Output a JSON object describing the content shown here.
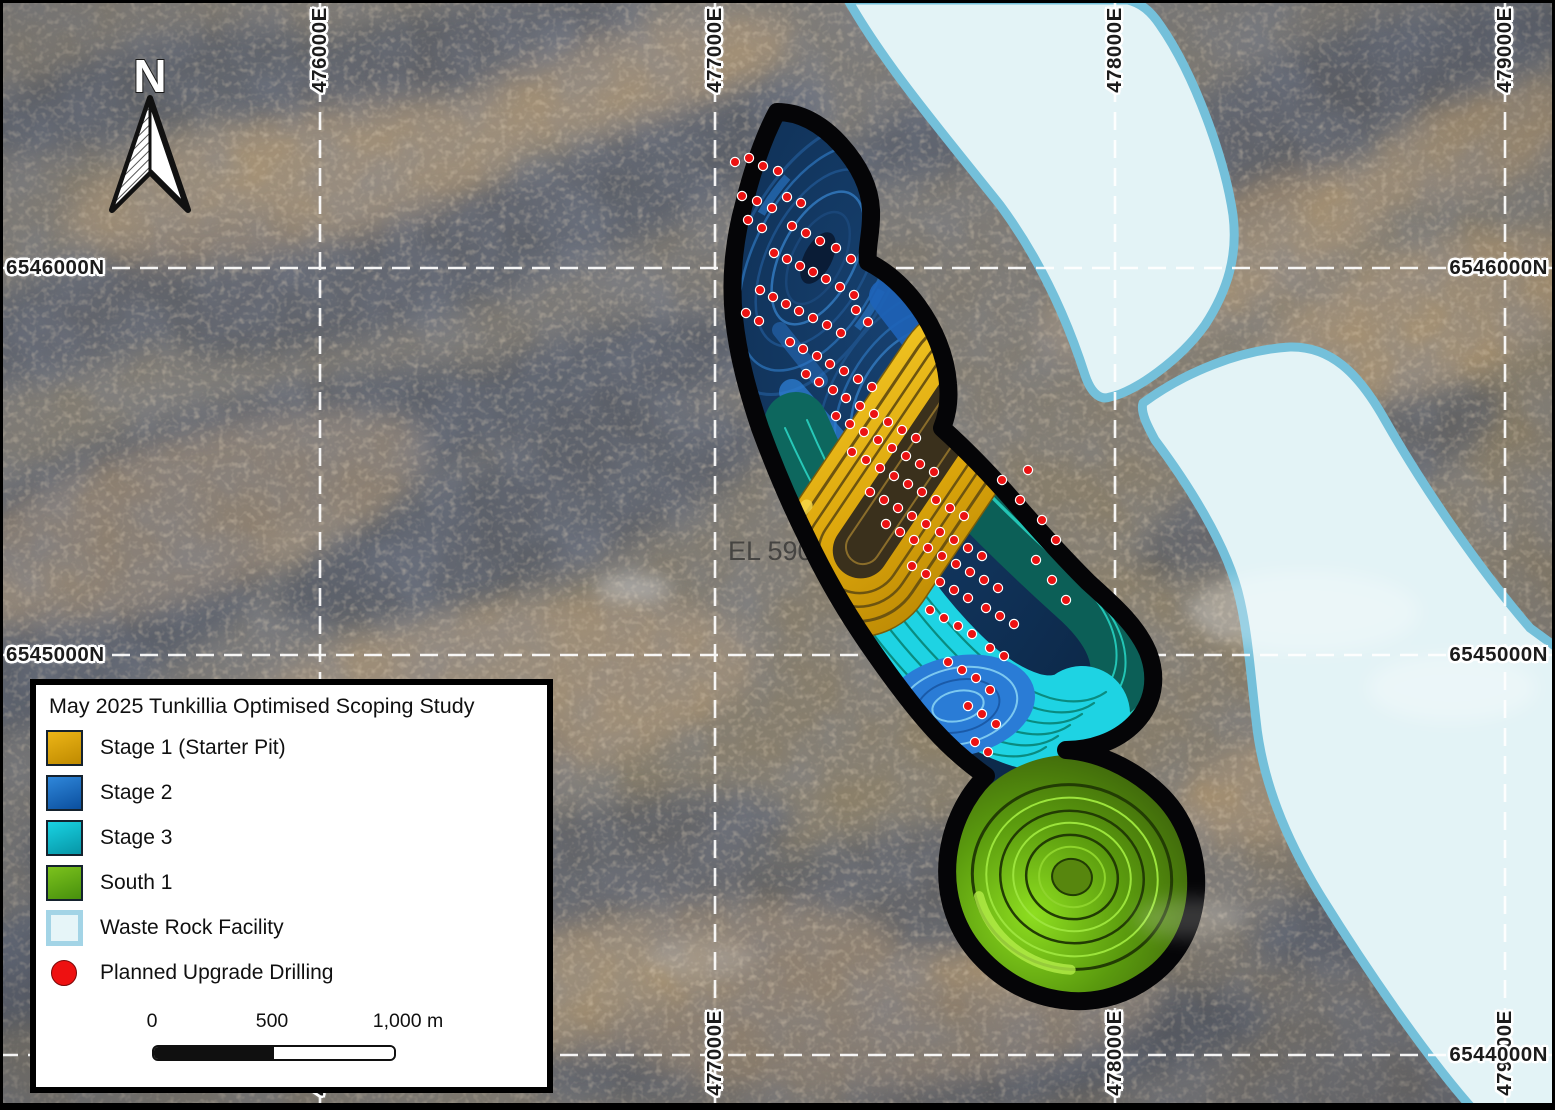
{
  "map": {
    "north_label": "N",
    "tenement_label": "EL 590",
    "frame_color": "#000000",
    "gridline_color": "#ffffff",
    "gridlines": {
      "eastings": [
        {
          "label": "476000E",
          "x": 320
        },
        {
          "label": "477000E",
          "x": 715
        },
        {
          "label": "478000E",
          "x": 1115
        },
        {
          "label": "479000E",
          "x": 1505
        }
      ],
      "northings": [
        {
          "label": "6546000N",
          "y": 268,
          "sides": [
            "left",
            "right"
          ]
        },
        {
          "label": "6545000N",
          "y": 655,
          "sides": [
            "left",
            "right"
          ]
        },
        {
          "label": "6544000N",
          "y": 1055,
          "sides": [
            "right"
          ]
        }
      ]
    },
    "drill_points": [
      [
        735,
        162
      ],
      [
        749,
        158
      ],
      [
        763,
        166
      ],
      [
        778,
        171
      ],
      [
        742,
        196
      ],
      [
        757,
        201
      ],
      [
        772,
        208
      ],
      [
        787,
        197
      ],
      [
        801,
        203
      ],
      [
        748,
        220
      ],
      [
        762,
        228
      ],
      [
        792,
        226
      ],
      [
        806,
        233
      ],
      [
        820,
        241
      ],
      [
        836,
        248
      ],
      [
        851,
        259
      ],
      [
        774,
        253
      ],
      [
        787,
        259
      ],
      [
        800,
        266
      ],
      [
        813,
        272
      ],
      [
        826,
        279
      ],
      [
        840,
        287
      ],
      [
        854,
        295
      ],
      [
        760,
        290
      ],
      [
        773,
        297
      ],
      [
        786,
        304
      ],
      [
        799,
        311
      ],
      [
        813,
        318
      ],
      [
        827,
        325
      ],
      [
        841,
        333
      ],
      [
        856,
        310
      ],
      [
        868,
        322
      ],
      [
        746,
        313
      ],
      [
        759,
        321
      ],
      [
        790,
        342
      ],
      [
        803,
        349
      ],
      [
        817,
        356
      ],
      [
        830,
        364
      ],
      [
        844,
        371
      ],
      [
        858,
        379
      ],
      [
        872,
        387
      ],
      [
        806,
        374
      ],
      [
        819,
        382
      ],
      [
        833,
        390
      ],
      [
        846,
        398
      ],
      [
        860,
        406
      ],
      [
        874,
        414
      ],
      [
        888,
        422
      ],
      [
        902,
        430
      ],
      [
        916,
        438
      ],
      [
        836,
        416
      ],
      [
        850,
        424
      ],
      [
        864,
        432
      ],
      [
        878,
        440
      ],
      [
        892,
        448
      ],
      [
        906,
        456
      ],
      [
        920,
        464
      ],
      [
        934,
        472
      ],
      [
        852,
        452
      ],
      [
        866,
        460
      ],
      [
        880,
        468
      ],
      [
        894,
        476
      ],
      [
        908,
        484
      ],
      [
        922,
        492
      ],
      [
        936,
        500
      ],
      [
        950,
        508
      ],
      [
        964,
        516
      ],
      [
        870,
        492
      ],
      [
        884,
        500
      ],
      [
        898,
        508
      ],
      [
        912,
        516
      ],
      [
        926,
        524
      ],
      [
        940,
        532
      ],
      [
        954,
        540
      ],
      [
        968,
        548
      ],
      [
        982,
        556
      ],
      [
        886,
        524
      ],
      [
        900,
        532
      ],
      [
        914,
        540
      ],
      [
        928,
        548
      ],
      [
        942,
        556
      ],
      [
        956,
        564
      ],
      [
        970,
        572
      ],
      [
        984,
        580
      ],
      [
        998,
        588
      ],
      [
        912,
        566
      ],
      [
        926,
        574
      ],
      [
        940,
        582
      ],
      [
        954,
        590
      ],
      [
        968,
        598
      ],
      [
        986,
        608
      ],
      [
        1000,
        616
      ],
      [
        1014,
        624
      ],
      [
        930,
        610
      ],
      [
        944,
        618
      ],
      [
        958,
        626
      ],
      [
        972,
        634
      ],
      [
        990,
        648
      ],
      [
        1004,
        656
      ],
      [
        948,
        662
      ],
      [
        962,
        670
      ],
      [
        976,
        678
      ],
      [
        990,
        690
      ],
      [
        968,
        706
      ],
      [
        982,
        714
      ],
      [
        996,
        724
      ],
      [
        975,
        742
      ],
      [
        988,
        752
      ],
      [
        1002,
        480
      ],
      [
        1020,
        500
      ],
      [
        1028,
        470
      ],
      [
        1042,
        520
      ],
      [
        1056,
        540
      ],
      [
        1036,
        560
      ],
      [
        1052,
        580
      ],
      [
        1066,
        600
      ]
    ]
  },
  "legend": {
    "title": "May 2025 Tunkillia Optimised Scoping Study",
    "items": [
      {
        "label": "Stage 1 (Starter Pit)",
        "swatch": "gradient",
        "color_top": "#ecb517",
        "color_bottom": "#bf8a00"
      },
      {
        "label": "Stage 2",
        "swatch": "gradient",
        "color_top": "#2f87da",
        "color_bottom": "#0b4f9e"
      },
      {
        "label": "Stage 3",
        "swatch": "gradient",
        "color_top": "#19d3e3",
        "color_bottom": "#0795a6"
      },
      {
        "label": "South 1",
        "swatch": "gradient",
        "color_top": "#7cc21d",
        "color_bottom": "#47900d"
      },
      {
        "label": "Waste Rock Facility",
        "swatch": "outlined",
        "color_top": "#e6f5f8",
        "color_bottom": "#e6f5f8",
        "border_color": "#a3d4e6"
      },
      {
        "label": "Planned Upgrade Drilling",
        "swatch": "dot",
        "color": "#ee1111"
      }
    ],
    "scalebar": {
      "tick_labels": [
        "0",
        "500",
        "1,000 m"
      ]
    }
  }
}
